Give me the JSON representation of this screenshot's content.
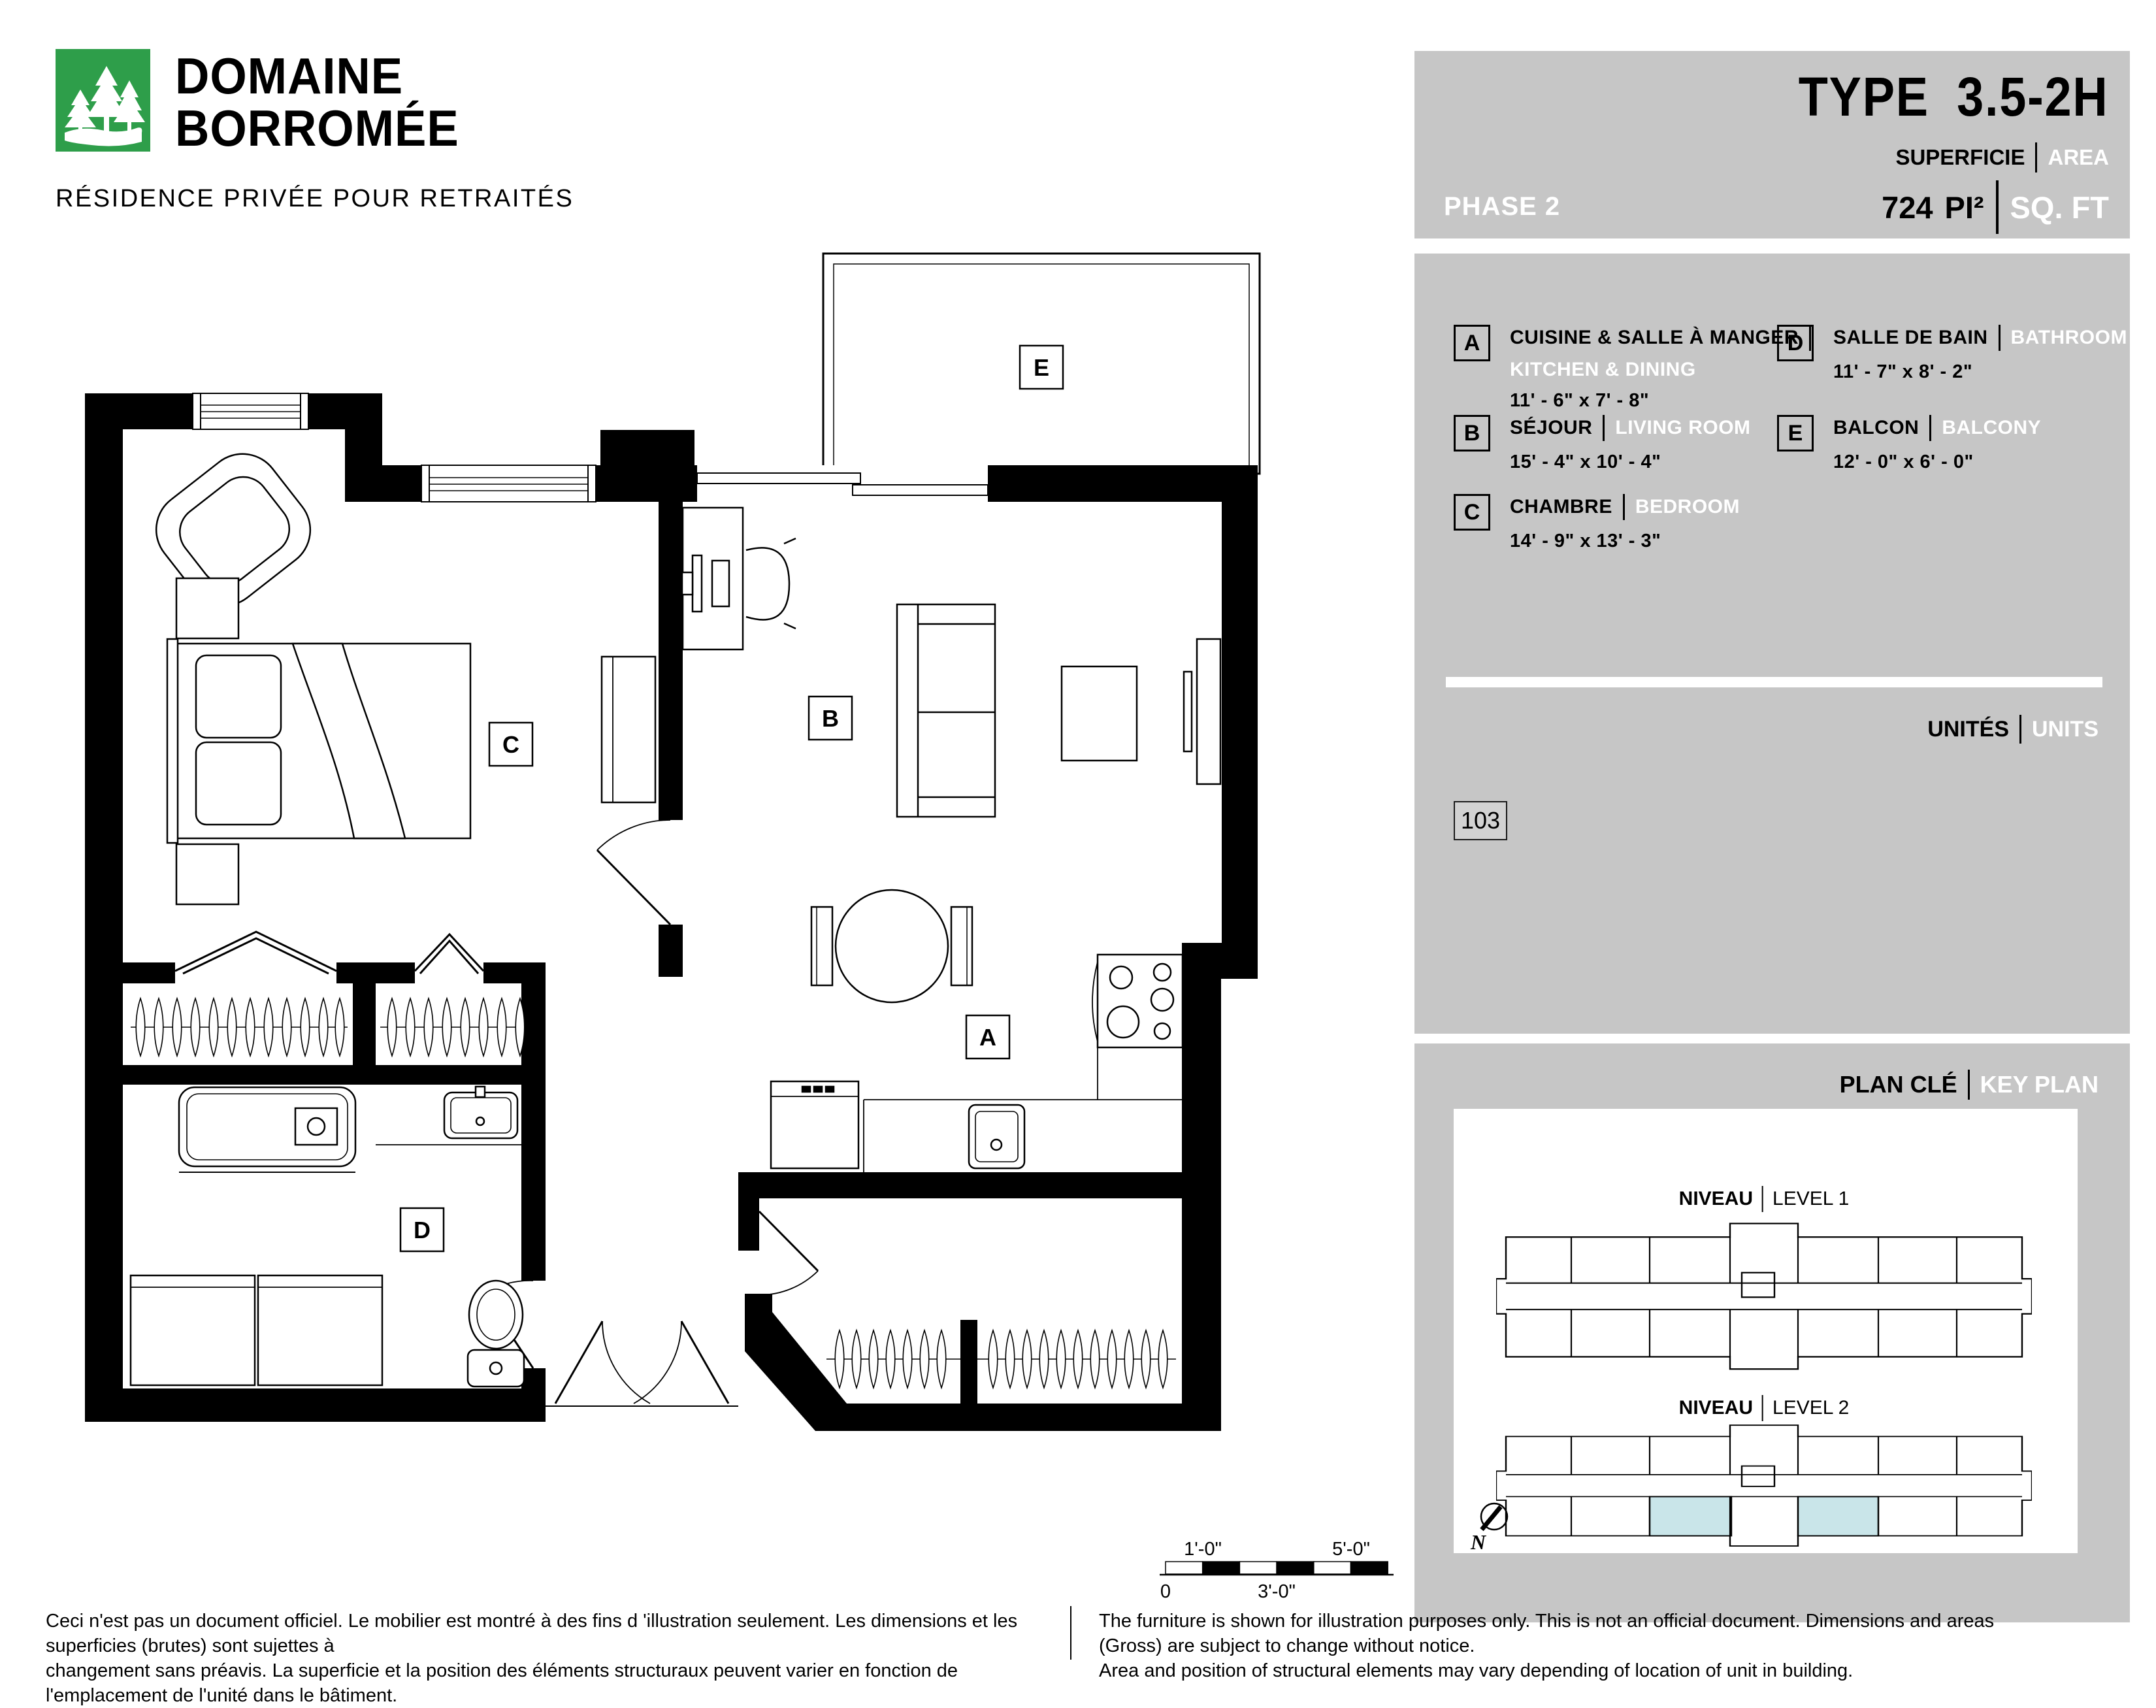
{
  "logo": {
    "line1": "DOMAINE",
    "line2": "BORROMÉE",
    "tagline": "RÉSIDENCE PRIVÉE POUR RETRAITÉS"
  },
  "header": {
    "phase": "PHASE 2",
    "type_word": "TYPE",
    "type_code": "3.5-2H",
    "superficie": "SUPERFICIE",
    "area": "AREA",
    "area_value": "724",
    "unit_fr": "PI²",
    "unit_en": "SQ. FT"
  },
  "legend": {
    "items": [
      {
        "letter": "A",
        "name_fr": "CUISINE & SALLE À MANGER",
        "name_en": "KITCHEN & DINING",
        "dims": "11' - 6\" x 7' - 8\""
      },
      {
        "letter": "B",
        "name_fr": "SÉJOUR",
        "name_en": "LIVING ROOM",
        "dims": "15' - 4\" x 10' - 4\""
      },
      {
        "letter": "C",
        "name_fr": "CHAMBRE",
        "name_en": "BEDROOM",
        "dims": "14' - 9\" x 13' - 3\""
      },
      {
        "letter": "D",
        "name_fr": "SALLE DE BAIN",
        "name_en": "BATHROOM",
        "dims": "11' - 7\" x 8' - 2\""
      },
      {
        "letter": "E",
        "name_fr": "BALCON",
        "name_en": "BALCONY",
        "dims": "12' - 0\" x 6' - 0\""
      }
    ]
  },
  "units": {
    "label_fr": "UNITÉS",
    "label_en": "UNITS",
    "numbers": [
      "103"
    ]
  },
  "key_plan": {
    "label_fr": "PLAN CLÉ",
    "label_en": "KEY PLAN",
    "level1_fr": "NIVEAU",
    "level1_en": "LEVEL 1",
    "level2_fr": "NIVEAU",
    "level2_en": "LEVEL 2",
    "north": "N",
    "highlight_color": "#c9e5e9"
  },
  "plan": {
    "labels": {
      "A": "A",
      "B": "B",
      "C": "C",
      "D": "D",
      "E": "E"
    }
  },
  "scale_bar": {
    "top1": "1'-0\"",
    "top2": "5'-0\"",
    "bottom1": "0",
    "bottom2": "3'-0\""
  },
  "footer": {
    "fr1": "Ceci n'est pas un document officiel.  Le mobilier est montré à des fins d 'illustration seulement.  Les dimensions et les superficies (brutes) sont sujettes à",
    "fr2": "changement sans préavis. La superficie et la position des éléments structuraux peuvent varier en fonction de l'emplacement de l'unité dans le bâtiment.",
    "en1": "The furniture is shown for illustration purposes only.  This is not an official document.  Dimensions and areas (Gross) are subject to change without notice.",
    "en2": "Area and position of structural elements may vary depending of location of unit in building."
  },
  "colors": {
    "brand_green": "#2e9e4a",
    "panel_gray": "#c6c6c6",
    "highlight_blue": "#c9e5e9",
    "wall_black": "#000000"
  }
}
